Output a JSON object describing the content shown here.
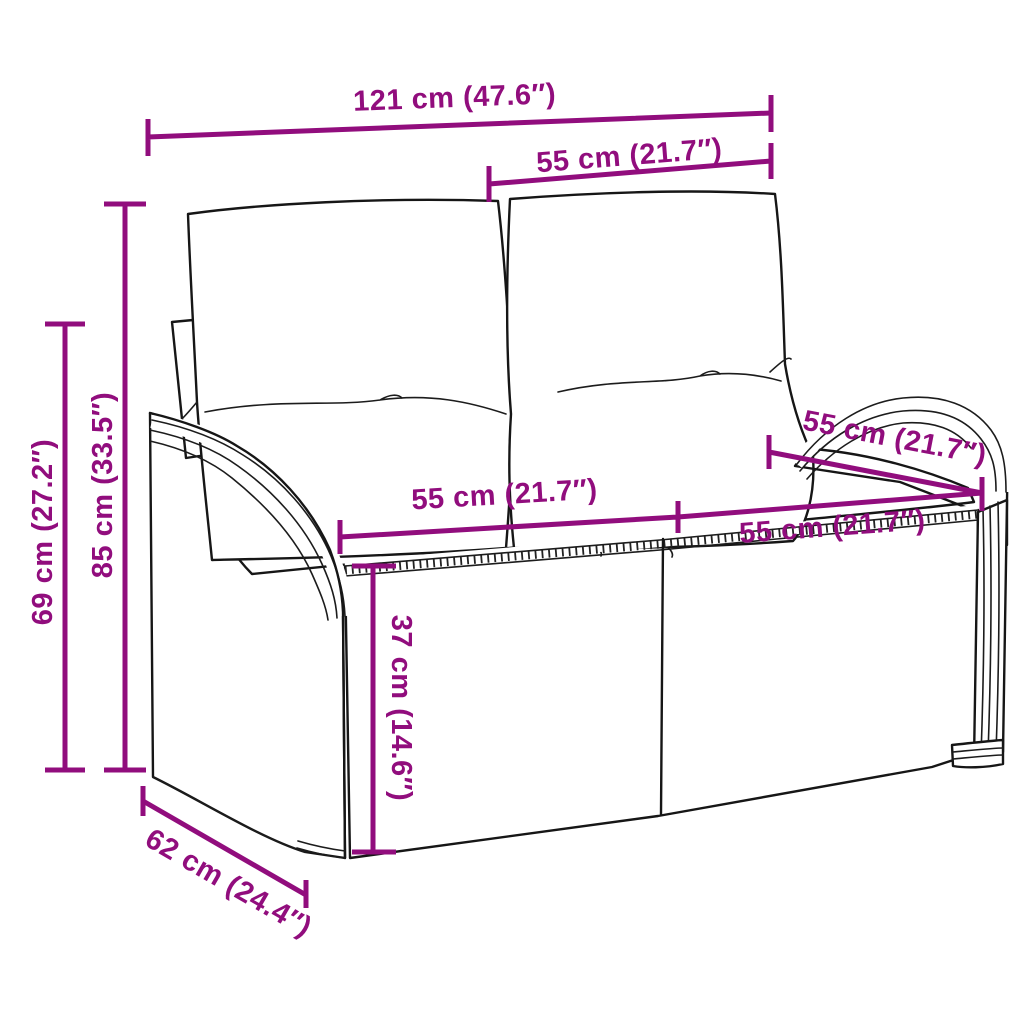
{
  "diagram": {
    "kind": "product-dimension-diagram",
    "product": "Poly rattan 2-seater garden bench with back and seat cushions",
    "accent_color": "#910d7d",
    "line_art_color": "#161616",
    "background_color": "#ffffff",
    "dims": {
      "total_width": "121 cm (47.6″)",
      "seat_section_top_width": "55 cm (21.7″)",
      "total_height": "85 cm (33.5″)",
      "armrest_height": "69 cm (27.2″)",
      "seat_width_left": "55 cm (21.7″)",
      "seat_depth_top_right": "55 cm (21.7″)",
      "seat_width_right": "55 cm (21.7″)",
      "seat_height": "37 cm (14.6″)",
      "overall_depth": "62 cm (24.4″)"
    }
  }
}
